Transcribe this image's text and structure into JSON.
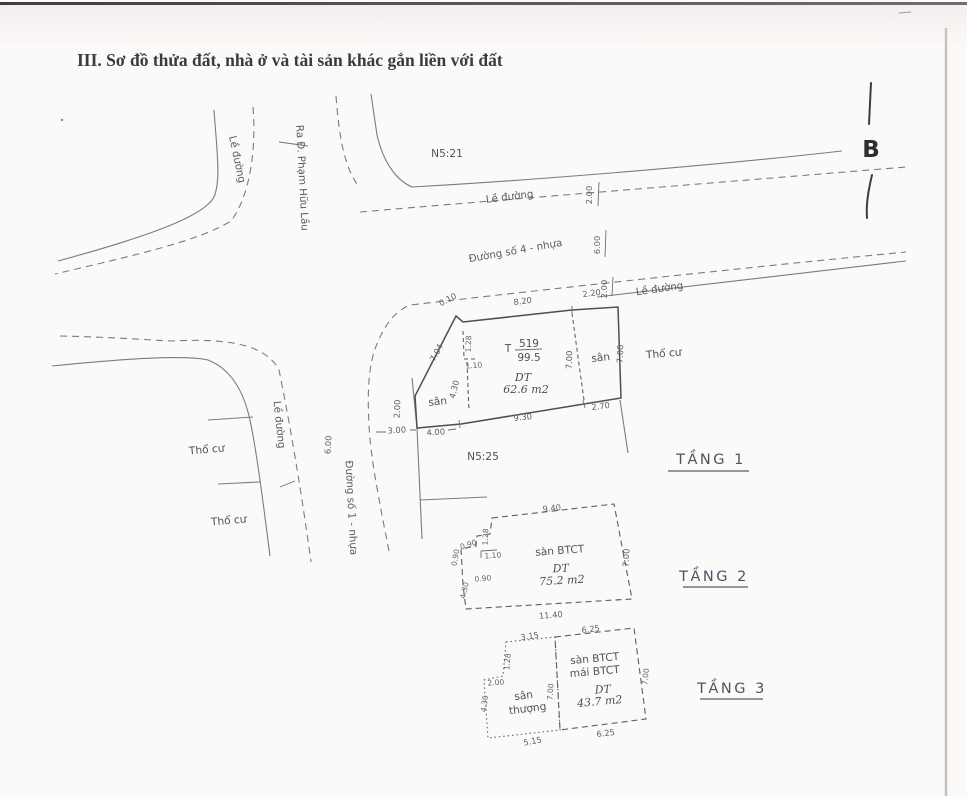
{
  "doc": {
    "title": "III. Sơ đồ thửa đất, nhà ở và tài sản khác gắn liền với đất",
    "compass": "B"
  },
  "plan": {
    "lots": {
      "north": "N5:21",
      "south": "N5:25"
    },
    "landuse": {
      "west1": "Thổ cư",
      "west2": "Thổ cư",
      "east": "Thổ cư"
    },
    "roads": {
      "sidewalk_nw": "Lề đường",
      "note_pham_huu_lau": "Ra Đ. Phạm Hữu Lầu",
      "sidewalk_north": "Lề đường",
      "road4": "Đường số 4 - nhựa",
      "sidewalk_east": "Lề đường",
      "sidewalk_west": "Lề đường",
      "road1": "Đường số 1 - nhựa",
      "dims": {
        "n": "2.00",
        "w": "6.00",
        "s": "2.00",
        "road1_w": "6.00"
      }
    },
    "parcel": {
      "prefix": "T",
      "number": "519",
      "denom": "99.5",
      "dt": "DT",
      "area": "62.6 m2",
      "yard_left": "sân",
      "yard_right": "sân",
      "dims": {
        "jog": "0.10",
        "top": "8.20",
        "top_right": "2.20",
        "slant": "7.04",
        "in_top": "1.28",
        "in_mid": "1.10",
        "in_bot": "4.30",
        "left": "2.00",
        "set_off": "3.00",
        "bottom_left": "4.00",
        "bottom": "9.30",
        "bottom_right": "2.70",
        "divider": "7.00",
        "right": "7.00"
      }
    }
  },
  "floors": {
    "f1": {
      "label": "TẦNG 1"
    },
    "f2": {
      "label": "TẦNG 2",
      "slab": "sàn BTCT",
      "dt": "DT",
      "area": "75.2 m2",
      "dims": {
        "top": "9.40",
        "bottom": "11.40",
        "right": "7.00",
        "left_top": "1.28",
        "notch1": "0.90",
        "notch2": "1.10",
        "notch3": "0.90",
        "left_outer": "0.90",
        "left_bottom": "4.30"
      }
    },
    "f3": {
      "label": "TẦNG 3",
      "slab1": "sàn BTCT",
      "slab2": "mái BTCT",
      "dt": "DT",
      "area": "43.7 m2",
      "terrace1": "sân",
      "terrace2": "thượng",
      "dims": {
        "t_top": "3.15",
        "t_bottom": "5.15",
        "t_left": "2.00",
        "t_vert": "4.30",
        "t_jog": "1.28",
        "mid": "7.00",
        "s_top": "6.25",
        "s_bottom": "6.25",
        "s_right": "7.00"
      }
    }
  }
}
